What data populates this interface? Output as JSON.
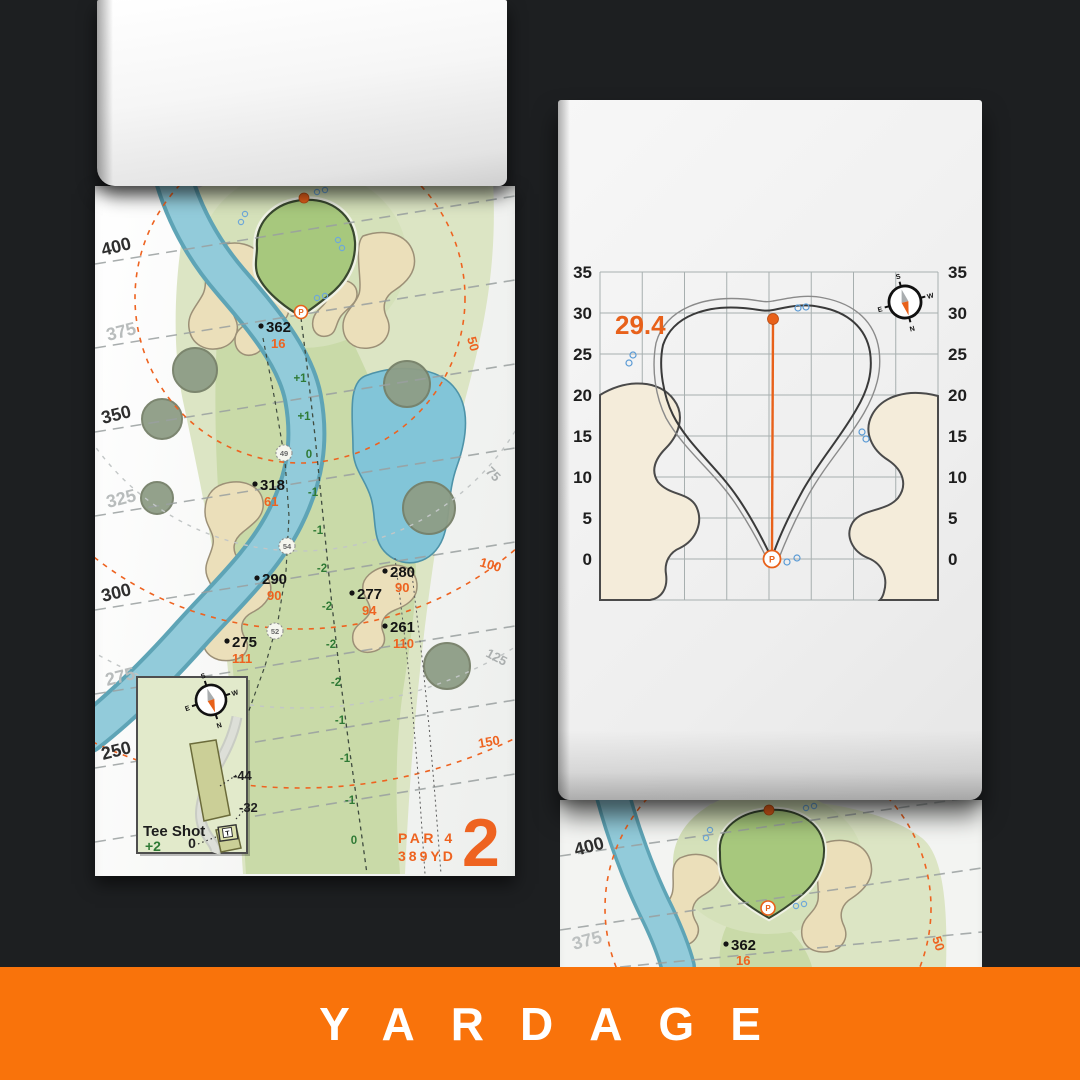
{
  "footer": {
    "label": "YARDAGE",
    "bg_color": "#F9730B",
    "text_color": "#FFFFFF"
  },
  "colors": {
    "background": "#1D1F21",
    "accent_orange": "#EE6320",
    "water": "#8FCBDA",
    "fairway": "#C9DAA8",
    "rough": "#DCE5C4",
    "green": "#A7C87D",
    "sand": "#EBDFBA"
  },
  "compass": {
    "n": "N",
    "s": "S",
    "e": "E",
    "w": "W"
  },
  "pin_glyph": "P",
  "hole_page": {
    "hole_number": "2",
    "par_label": "PAR 4",
    "distance_label": "389YD",
    "yardage_lines": [
      {
        "label": "400",
        "emphasis": true
      },
      {
        "label": "375",
        "emphasis": false
      },
      {
        "label": "350",
        "emphasis": true
      },
      {
        "label": "325",
        "emphasis": false
      },
      {
        "label": "300",
        "emphasis": true
      },
      {
        "label": "275",
        "emphasis": false
      },
      {
        "label": "250",
        "emphasis": true
      }
    ],
    "range_rings": [
      {
        "label": "50",
        "color": "orange"
      },
      {
        "label": "75",
        "color": "gray"
      },
      {
        "label": "100",
        "color": "orange"
      },
      {
        "label": "125",
        "color": "gray"
      },
      {
        "label": "150",
        "color": "orange"
      }
    ],
    "markers": [
      {
        "to_green": "362",
        "from_ref": "16"
      },
      {
        "to_green": "318",
        "from_ref": "61"
      },
      {
        "to_green": "290",
        "from_ref": "90"
      },
      {
        "to_green": "280",
        "from_ref": "90"
      },
      {
        "to_green": "277",
        "from_ref": "94"
      },
      {
        "to_green": "261",
        "from_ref": "110"
      },
      {
        "to_green": "275",
        "from_ref": "111"
      }
    ],
    "waypoints": [
      "49",
      "54",
      "52"
    ],
    "centerline_elevations": [
      "+1",
      "+1",
      "0",
      "-1",
      "-1",
      "-2",
      "-2",
      "-2",
      "-2",
      "-1",
      "-1",
      "-1",
      "0"
    ],
    "tee_inset": {
      "title": "Tee Shot",
      "elevation": "+2",
      "offsets": [
        "-44",
        "-32",
        "0"
      ],
      "tee_marker": "T"
    }
  },
  "green_page": {
    "pin_depth": "29.4",
    "axis_ticks": [
      "35",
      "30",
      "25",
      "20",
      "15",
      "10",
      "5",
      "0"
    ]
  },
  "next_page": {
    "yardage_lines": [
      {
        "label": "400",
        "emphasis": true
      },
      {
        "label": "375",
        "emphasis": false
      }
    ],
    "marker": {
      "to_green": "362",
      "from_ref": "16"
    },
    "ring_label": "50"
  }
}
